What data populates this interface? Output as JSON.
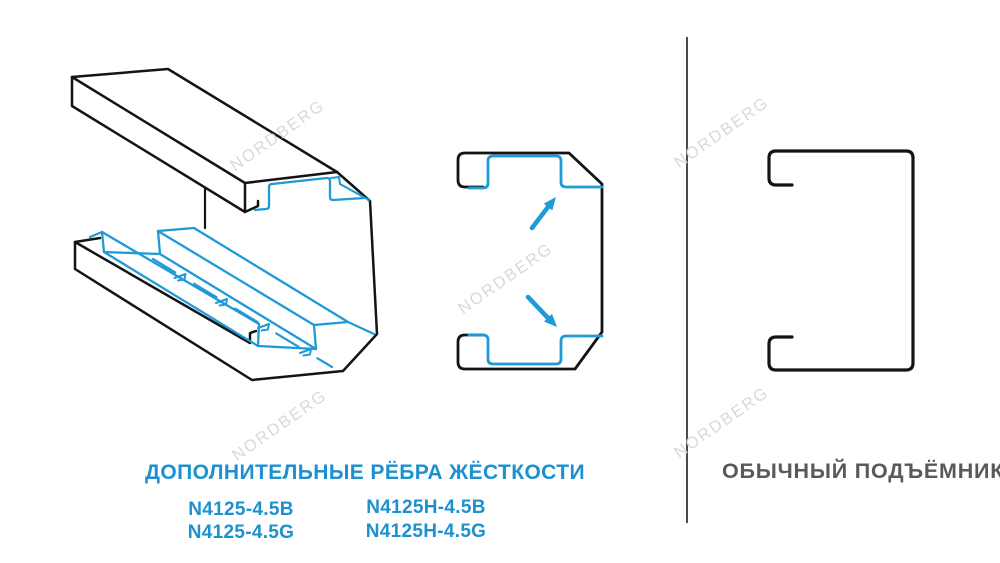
{
  "headings": {
    "left": "ДОПОЛНИТЕЛЬНЫЕ РЁБРА ЖЁСТКОСТИ",
    "right": "ОБЫЧНЫЙ ПОДЪЁМНИК"
  },
  "models": {
    "col1": [
      "N4125-4.5B",
      "N4125-4.5G"
    ],
    "col2": [
      "N4125H-4.5B",
      "N4125H-4.5G"
    ]
  },
  "watermark": {
    "text": "NORDBERG"
  },
  "icons": {
    "arrow_up": "blue diagonal arrow pointing to upper stiffening rib",
    "arrow_down": "blue diagonal arrow pointing to lower stiffening rib"
  },
  "colors": {
    "accent_blue": "#1e9ad6",
    "text_blue": "#1d91cf",
    "text_gray": "#58595b",
    "line_black": "#141414",
    "watermark_gray": "#d9d9d9",
    "divider_gray": "#4a4a4a",
    "background": "#ffffff"
  }
}
